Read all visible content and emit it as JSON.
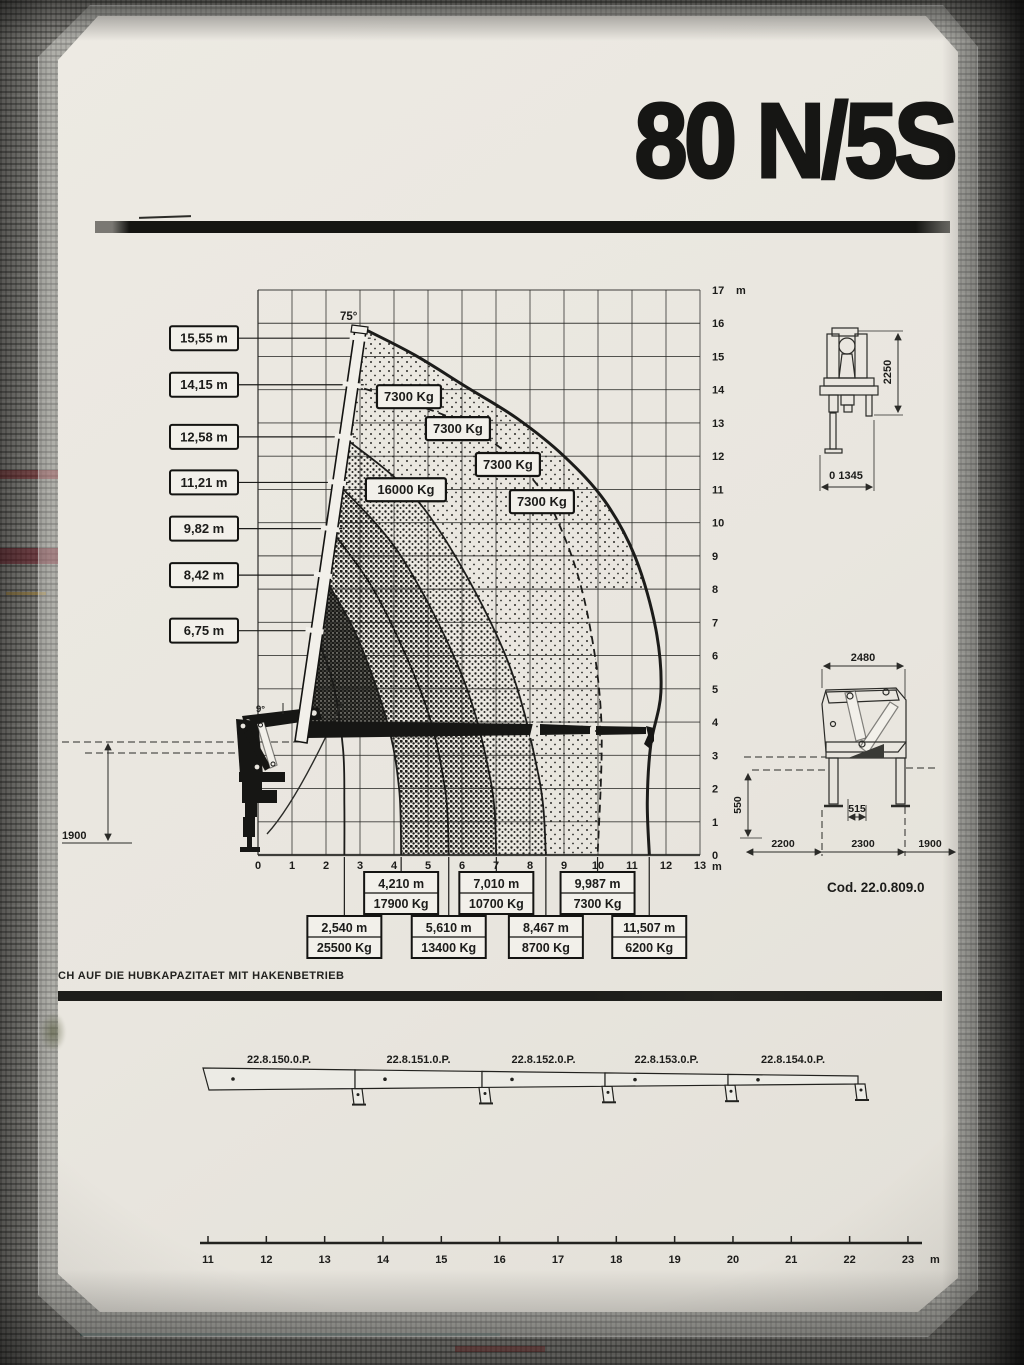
{
  "sheet": {
    "title": "80 N/5S",
    "note": "CH AUF DIE HUBKAPAZITAET MIT HAKENBETRIEB",
    "code_label": "Cod. 22.0.809.0",
    "ink_color": "#1c1c1a",
    "paper_color": "#e9e6df"
  },
  "chart_data": {
    "type": "line",
    "title": "Crane lifting capacity envelope 80 N/5S",
    "x_unit": "m",
    "y_unit": "m",
    "xlim": [
      0,
      13
    ],
    "ylim": [
      0,
      17
    ],
    "grid": true,
    "x_ticks": [
      "0",
      "1",
      "2",
      "3",
      "4",
      "5",
      "6",
      "7",
      "8",
      "9",
      "10",
      "11",
      "12",
      "13"
    ],
    "y_ticks": [
      "0",
      "1",
      "2",
      "3",
      "4",
      "5",
      "6",
      "7",
      "8",
      "9",
      "10",
      "11",
      "12",
      "13",
      "14",
      "15",
      "16",
      "17"
    ],
    "boom_angle_label": "75°",
    "boom_min_angle_label": "9°",
    "ground_dim": "1900",
    "hook_heights": [
      {
        "label": "15,55 m",
        "height_m": 15.55
      },
      {
        "label": "14,15 m",
        "height_m": 14.15
      },
      {
        "label": "12,58 m",
        "height_m": 12.58
      },
      {
        "label": "11,21 m",
        "height_m": 11.21
      },
      {
        "label": "9,82 m",
        "height_m": 9.82
      },
      {
        "label": "8,42 m",
        "height_m": 8.42
      },
      {
        "label": "6,75 m",
        "height_m": 6.75
      }
    ],
    "capacity_labels": [
      {
        "text": "7300 Kg",
        "x_m": 4.44,
        "y_m": 13.79
      },
      {
        "text": "7300 Kg",
        "x_m": 5.88,
        "y_m": 12.83
      },
      {
        "text": "7300 Kg",
        "x_m": 7.35,
        "y_m": 11.75
      },
      {
        "text": "7300 Kg",
        "x_m": 8.35,
        "y_m": 10.63
      },
      {
        "text": "16000 Kg",
        "x_m": 4.35,
        "y_m": 10.99
      }
    ],
    "curves": [
      {
        "outreach_m": 2.54,
        "style": "solid",
        "pts": [
          [
            1.66,
            6.75
          ],
          [
            2.2,
            5.2
          ],
          [
            2.5,
            3.2
          ],
          [
            2.54,
            1.5
          ],
          [
            2.54,
            0
          ]
        ]
      },
      {
        "outreach_m": 4.21,
        "style": "solid",
        "pts": [
          [
            1.91,
            8.42
          ],
          [
            2.9,
            6.6
          ],
          [
            3.8,
            4.0
          ],
          [
            4.15,
            2.0
          ],
          [
            4.21,
            0
          ]
        ]
      },
      {
        "outreach_m": 5.61,
        "style": "solid",
        "pts": [
          [
            2.12,
            9.82
          ],
          [
            3.5,
            7.8
          ],
          [
            4.9,
            4.6
          ],
          [
            5.5,
            2.0
          ],
          [
            5.61,
            0
          ]
        ]
      },
      {
        "outreach_m": 7.01,
        "style": "solid",
        "pts": [
          [
            2.32,
            11.21
          ],
          [
            4.2,
            9.0
          ],
          [
            6.0,
            5.4
          ],
          [
            6.85,
            2.2
          ],
          [
            7.01,
            0
          ]
        ]
      },
      {
        "outreach_m": 8.47,
        "style": "solid",
        "pts": [
          [
            2.52,
            12.58
          ],
          [
            4.9,
            10.4
          ],
          [
            7.2,
            6.2
          ],
          [
            8.25,
            2.4
          ],
          [
            8.47,
            0
          ]
        ]
      },
      {
        "outreach_m": 9.987,
        "style": "dashed",
        "pts": [
          [
            2.76,
            14.15
          ],
          [
            6.0,
            13.0
          ],
          [
            8.0,
            11.4
          ],
          [
            9.0,
            9.6
          ],
          [
            9.7,
            7.2
          ],
          [
            10.1,
            4.0
          ],
          [
            9.99,
            0
          ]
        ]
      },
      {
        "outreach_m": 11.507,
        "style": "envelope",
        "pts": [
          [
            3.02,
            15.88
          ],
          [
            4.6,
            15.05
          ],
          [
            6.1,
            14.1
          ],
          [
            7.6,
            13.15
          ],
          [
            9.0,
            12.0
          ],
          [
            10.2,
            10.65
          ],
          [
            11.1,
            8.95
          ],
          [
            11.7,
            6.8
          ],
          [
            11.85,
            4.9
          ],
          [
            11.55,
            3.3
          ],
          [
            11.45,
            1.6
          ],
          [
            11.51,
            0
          ]
        ]
      }
    ],
    "outreach_labels": [
      {
        "reach": "2,540 m",
        "load": "25500 Kg",
        "x_m": 2.54,
        "row": 2
      },
      {
        "reach": "4,210 m",
        "load": "17900 Kg",
        "x_m": 4.21,
        "row": 1
      },
      {
        "reach": "5,610 m",
        "load": "13400 Kg",
        "x_m": 5.61,
        "row": 2
      },
      {
        "reach": "7,010 m",
        "load": "10700 Kg",
        "x_m": 7.01,
        "row": 1
      },
      {
        "reach": "8,467 m",
        "load": "8700 Kg",
        "x_m": 8.467,
        "row": 2
      },
      {
        "reach": "9,987 m",
        "load": "7300 Kg",
        "x_m": 9.987,
        "row": 1
      },
      {
        "reach": "11,507 m",
        "load": "6200 Kg",
        "x_m": 11.507,
        "row": 2
      }
    ]
  },
  "dimension_drawings": {
    "front_view": {
      "height": "2250",
      "width": "0 1345"
    },
    "side_view": {
      "width": "2480",
      "center_offset": "515",
      "leg_height": "550",
      "spans": [
        "2200",
        "2300",
        "1900"
      ]
    }
  },
  "extensions": {
    "labels": [
      "22.8.150.0.P.",
      "22.8.151.0.P.",
      "22.8.152.0.P.",
      "22.8.153.0.P.",
      "22.8.154.0.P."
    ]
  },
  "ruler": {
    "ticks": [
      "11",
      "12",
      "13",
      "14",
      "15",
      "16",
      "17",
      "18",
      "19",
      "20",
      "21",
      "22",
      "23"
    ],
    "unit": "m"
  }
}
